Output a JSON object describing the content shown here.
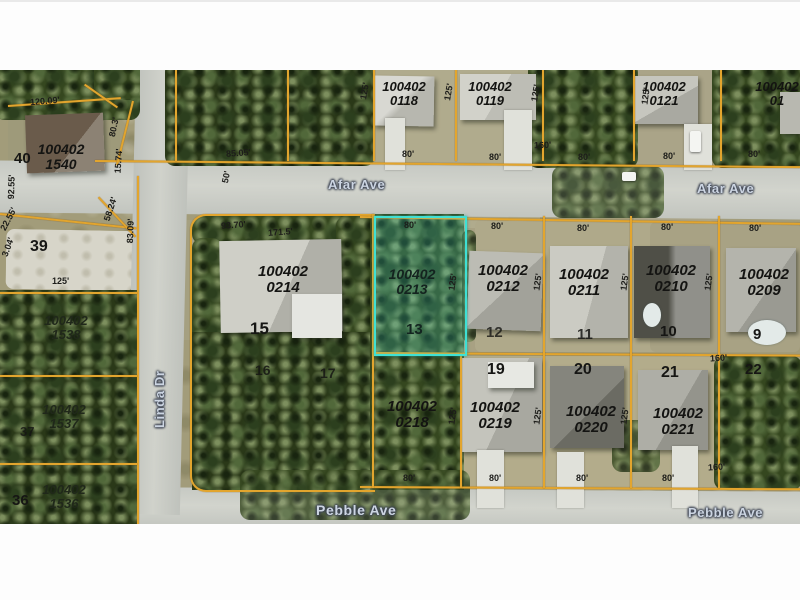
{
  "streets": {
    "afar_left": "Afar Ave",
    "afar_right": "Afar Ave",
    "pebble_left": "Pebble Ave",
    "pebble_right": "Pebble Ave",
    "linda": "Linda Dr"
  },
  "parcels": [
    {
      "line1": "100402",
      "line2": "0118",
      "lot": ""
    },
    {
      "line1": "100402",
      "line2": "0119",
      "lot": ""
    },
    {
      "line1": "100402",
      "line2": "0121",
      "lot": ""
    },
    {
      "line1": "100402",
      "line2": "01",
      "lot": ""
    },
    {
      "line1": "100402",
      "line2": "1540",
      "lot": "40"
    },
    {
      "line1": "100402",
      "line2": "1538",
      "lot": ""
    },
    {
      "line1": "100402",
      "line2": "1537",
      "lot": "37"
    },
    {
      "line1": "100402",
      "line2": "1536",
      "lot": "36"
    },
    {
      "line1": "100402",
      "line2": "0214",
      "lot": "15"
    },
    {
      "line1": "100402",
      "line2": "0213",
      "lot": "13",
      "highlighted": true
    },
    {
      "line1": "100402",
      "line2": "0212",
      "lot": "12"
    },
    {
      "line1": "100402",
      "line2": "0211",
      "lot": "11"
    },
    {
      "line1": "100402",
      "line2": "0210",
      "lot": "10"
    },
    {
      "line1": "100402",
      "line2": "0209",
      "lot": "9"
    },
    {
      "line1": "100402",
      "line2": "0218",
      "lot": ""
    },
    {
      "line1": "100402",
      "line2": "0219",
      "lot": "19"
    },
    {
      "line1": "100402",
      "line2": "0220",
      "lot": "20"
    },
    {
      "line1": "100402",
      "line2": "0221",
      "lot": "21"
    }
  ],
  "lots": [
    "39",
    "16",
    "17",
    "22"
  ],
  "dims": [
    "120.09'",
    "80.3'",
    "15.74'",
    "92.55'",
    "22.55'",
    "3.04'",
    "83.09'",
    "58.24'",
    "125'",
    "50'",
    "85.05'",
    "125'",
    "80'",
    "125'",
    "80'",
    "160'",
    "80'",
    "125'",
    "80'",
    "80'",
    "93.70'",
    "171.5'",
    "80'",
    "125'",
    "80'",
    "125'",
    "80'",
    "125'",
    "80'",
    "125'",
    "80'",
    "125'",
    "80'",
    "80'",
    "125'",
    "80'",
    "125'",
    "80'",
    "160'",
    "160'",
    "125'"
  ],
  "colors": {
    "highlight": "#3fe0d4",
    "parcel_line": "#e2a52e",
    "street_label": "#ccd5e2"
  }
}
